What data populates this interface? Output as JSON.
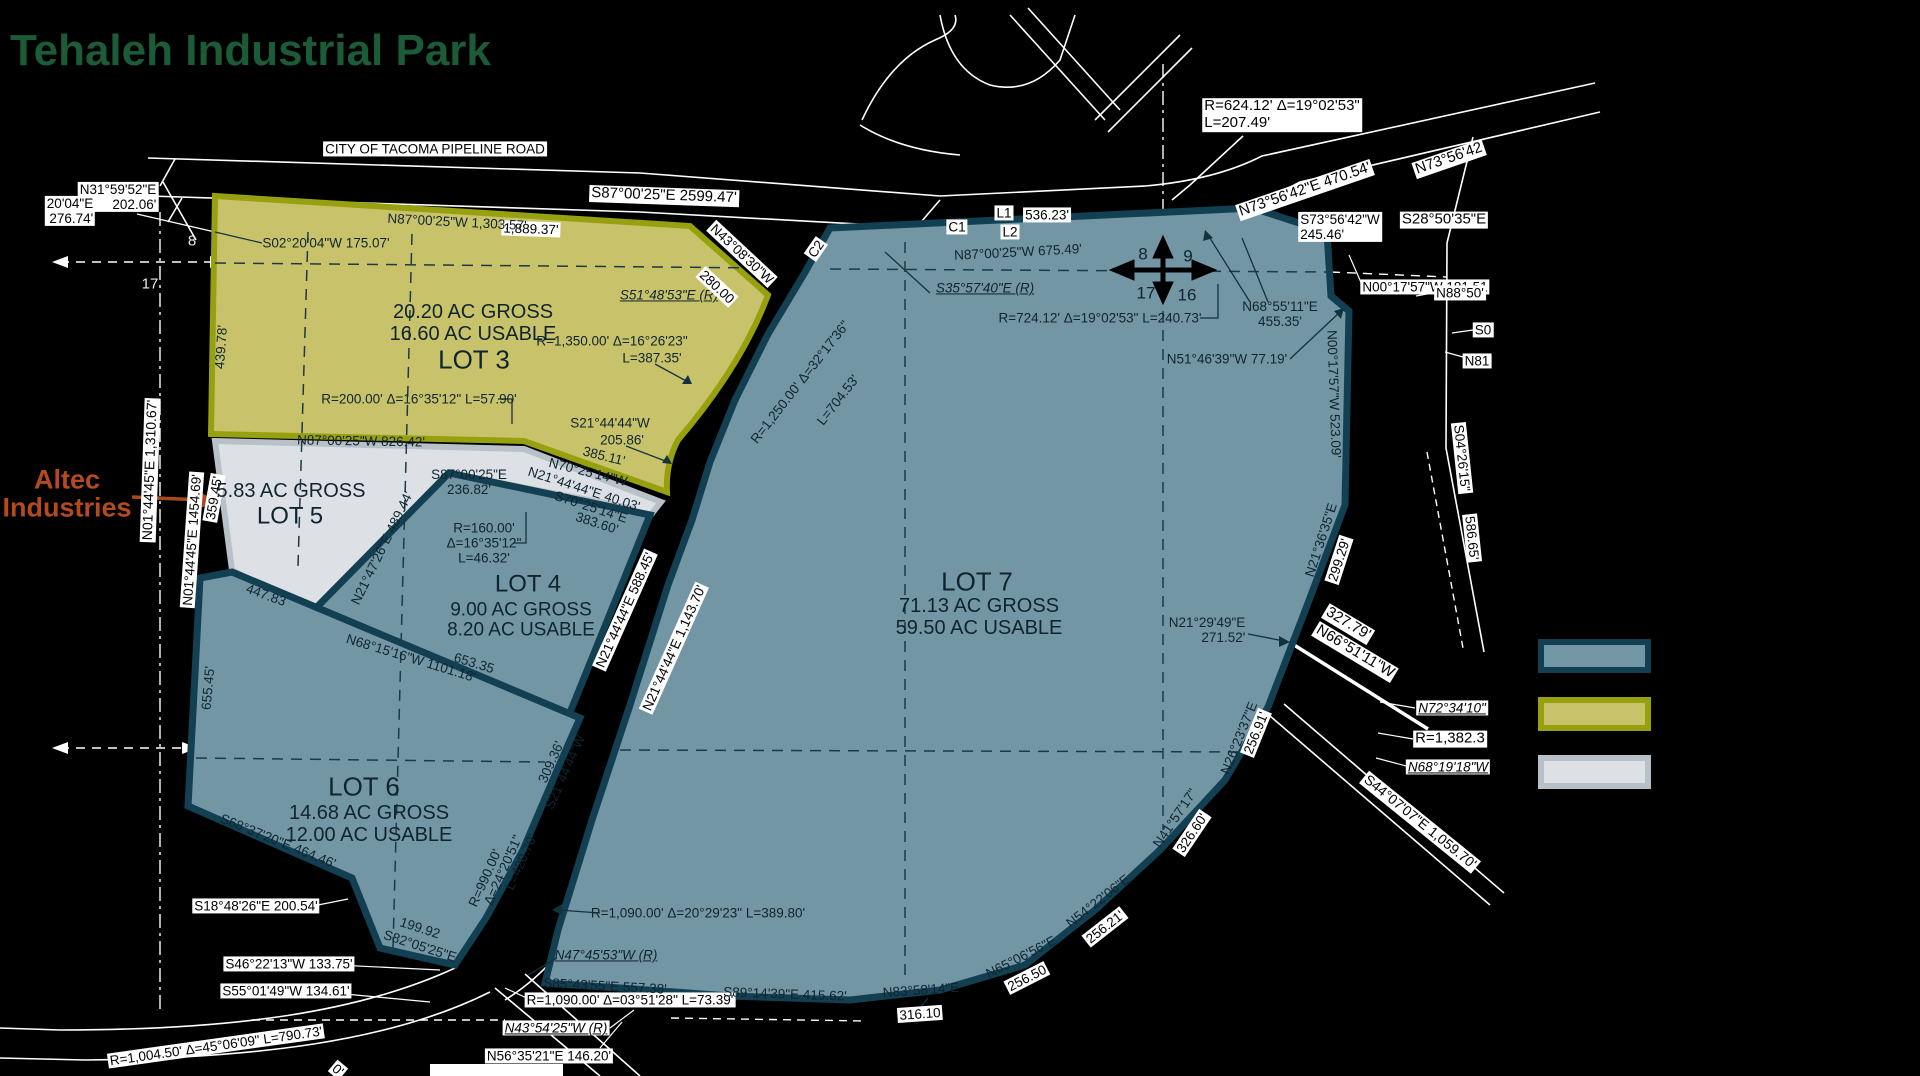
{
  "title": "Tehaleh Industrial Park",
  "legend": {
    "items": [
      {
        "name": "parcel-teal",
        "fill": "#7296a4",
        "border": "#123f52"
      },
      {
        "name": "parcel-olive",
        "fill": "#c8c36b",
        "border": "#97a00f"
      },
      {
        "name": "parcel-gray",
        "fill": "#dde1e6",
        "border": "#b8c0c8"
      }
    ]
  },
  "lots": [
    {
      "name": "LOT 3",
      "gross": "20.20 AC GROSS",
      "usable": "16.60 AC USABLE",
      "color": "#c8c36b"
    },
    {
      "name": "LOT 4",
      "gross": "9.00 AC GROSS",
      "usable": "8.20 AC USABLE",
      "color": "#7296a4"
    },
    {
      "name": "LOT 5",
      "gross": "5.83 AC GROSS",
      "usable": "",
      "color": "#dde1e6",
      "occupant": "Altec Industries"
    },
    {
      "name": "LOT 6",
      "gross": "14.68 AC GROSS",
      "usable": "12.00 AC USABLE",
      "color": "#7296a4"
    },
    {
      "name": "LOT 7",
      "gross": "71.13 AC GROSS",
      "usable": "59.50 AC USABLE",
      "color": "#7296a4"
    }
  ],
  "labels": [
    {
      "t": "CITY OF TACOMA PIPELINE ROAD",
      "x": 435,
      "y": 149,
      "s": "chip",
      "n": "road-name"
    },
    {
      "t": "N31°59'52\"E\n202.06'",
      "x": 118,
      "y": 197,
      "s": "chip",
      "al": "right"
    },
    {
      "t": "20'04\"E\n276.74'",
      "x": 70,
      "y": 211,
      "s": "chip",
      "al": "right"
    },
    {
      "t": "S87°00'25\"E  2599.47'",
      "x": 664,
      "y": 196,
      "r": 2,
      "s": "chip",
      "fs": 15
    },
    {
      "t": "1,889.37'",
      "x": 531,
      "y": 229,
      "r": 2,
      "s": "chip"
    },
    {
      "t": "N87°00'25\"W 1,303.57'",
      "x": 457,
      "y": 222,
      "r": 3,
      "s": "plain"
    },
    {
      "t": "S02°20'04\"W 175.07'",
      "x": 326,
      "y": 243,
      "s": "plain"
    },
    {
      "t": "439.78'",
      "x": 221,
      "y": 347,
      "r": -86,
      "s": "plain"
    },
    {
      "t": "20.20 AC GROSS",
      "x": 473,
      "y": 312,
      "s": "plain",
      "fs": 20,
      "n": "lot3-gross"
    },
    {
      "t": "16.60 AC USABLE",
      "x": 473,
      "y": 334,
      "s": "plain",
      "fs": 20,
      "n": "lot3-usable"
    },
    {
      "t": "LOT 3",
      "x": 474,
      "y": 360,
      "s": "plain",
      "fs": 26,
      "n": "lot3-title"
    },
    {
      "t": "S51°48'53\"E (R)",
      "x": 669,
      "y": 295,
      "s": "plainI"
    },
    {
      "t": "N43°08'30\"W",
      "x": 742,
      "y": 254,
      "r": 43,
      "s": "chip"
    },
    {
      "t": "280.00",
      "x": 717,
      "y": 287,
      "r": 43,
      "s": "chip"
    },
    {
      "t": "R=1,350.00' Δ=16°26'23\"",
      "x": 612,
      "y": 341,
      "s": "plain"
    },
    {
      "t": "L=387.35'",
      "x": 652,
      "y": 358,
      "s": "plain"
    },
    {
      "t": "R=200.00' Δ=16°35'12\" L=57.90'",
      "x": 419,
      "y": 399,
      "s": "plain"
    },
    {
      "t": "N87°00'25\"W 826.42'",
      "x": 361,
      "y": 441,
      "r": 1,
      "s": "plain"
    },
    {
      "t": "S21°44'44\"W",
      "x": 610,
      "y": 423,
      "s": "plain"
    },
    {
      "t": "205.86'",
      "x": 622,
      "y": 440,
      "s": "plain"
    },
    {
      "t": "385.11'",
      "x": 604,
      "y": 456,
      "r": 14,
      "s": "plain"
    },
    {
      "t": "N70°25'14\"W",
      "x": 588,
      "y": 472,
      "r": 14,
      "s": "plain"
    },
    {
      "t": "N21°44'44\"E 40.03'",
      "x": 584,
      "y": 489,
      "r": 18,
      "s": "plain"
    },
    {
      "t": "S70°25'14\"E",
      "x": 591,
      "y": 507,
      "r": 18,
      "s": "plain"
    },
    {
      "t": "383.60'",
      "x": 597,
      "y": 523,
      "r": 18,
      "s": "plain"
    },
    {
      "t": "S87°00'25\"E\n236.82'",
      "x": 469,
      "y": 482,
      "s": "plain"
    },
    {
      "t": "R=160.00'\nΔ=16°35'12\"\nL=46.32'",
      "x": 484,
      "y": 543,
      "s": "plain"
    },
    {
      "t": "LOT 4",
      "x": 528,
      "y": 585,
      "s": "plain",
      "fs": 24,
      "n": "lot4-title"
    },
    {
      "t": "9.00 AC GROSS",
      "x": 521,
      "y": 610,
      "s": "plain",
      "fs": 19,
      "n": "lot4-gross"
    },
    {
      "t": "8.20 AC USABLE",
      "x": 521,
      "y": 630,
      "s": "plain",
      "fs": 19,
      "n": "lot4-usable"
    },
    {
      "t": "N21°47'26\"E  489.44'",
      "x": 382,
      "y": 548,
      "r": -64,
      "s": "plain"
    },
    {
      "t": "N21°44'44\"E  588.45'",
      "x": 625,
      "y": 610,
      "r": -66,
      "s": "chip"
    },
    {
      "t": "N21°44'44\"E  1,143.70'",
      "x": 674,
      "y": 648,
      "r": -66,
      "s": "chip"
    },
    {
      "t": "N01°44'45\"E  1,310.67'",
      "x": 150,
      "y": 470,
      "r": -88,
      "s": "chip",
      "fs": 14
    },
    {
      "t": "N01°44'45\"E  1454.69'",
      "x": 192,
      "y": 540,
      "r": -86,
      "s": "chip"
    },
    {
      "t": "359.45'",
      "x": 214,
      "y": 498,
      "r": -80,
      "s": "chip"
    },
    {
      "t": "5.83 AC GROSS",
      "x": 291,
      "y": 491,
      "s": "plain",
      "fs": 20,
      "n": "lot5-gross"
    },
    {
      "t": "LOT 5",
      "x": 290,
      "y": 517,
      "s": "plain",
      "fs": 24,
      "n": "lot5-title"
    },
    {
      "t": "447.83",
      "x": 266,
      "y": 595,
      "r": 20,
      "s": "plain"
    },
    {
      "t": "Altec\nIndustries",
      "x": 67,
      "y": 494,
      "s": "altec",
      "n": "altec-industries-callout"
    },
    {
      "t": "N68°15'16\"W 1101.18'",
      "x": 411,
      "y": 658,
      "r": 17,
      "s": "plain"
    },
    {
      "t": "653.35",
      "x": 474,
      "y": 663,
      "r": 17,
      "s": "plain"
    },
    {
      "t": "655.45'",
      "x": 208,
      "y": 688,
      "r": -85,
      "s": "plain"
    },
    {
      "t": "LOT 6",
      "x": 364,
      "y": 787,
      "s": "plain",
      "fs": 26,
      "n": "lot6-title"
    },
    {
      "t": "14.68 AC GROSS",
      "x": 369,
      "y": 813,
      "s": "plain",
      "fs": 20,
      "n": "lot6-gross"
    },
    {
      "t": "12.00 AC USABLE",
      "x": 369,
      "y": 835,
      "s": "plain",
      "fs": 20,
      "n": "lot6-usable"
    },
    {
      "t": "S68°37'20\"E 464.46'",
      "x": 278,
      "y": 841,
      "r": 22,
      "s": "plain"
    },
    {
      "t": "309.36'",
      "x": 551,
      "y": 762,
      "r": -66,
      "s": "plain"
    },
    {
      "t": "S21°44'44\"W",
      "x": 565,
      "y": 772,
      "r": -66,
      "s": "plain"
    },
    {
      "t": "R=990.00'",
      "x": 485,
      "y": 878,
      "r": -66,
      "s": "plain"
    },
    {
      "t": "Δ=24°20'51\"",
      "x": 503,
      "y": 870,
      "r": -66,
      "s": "plain"
    },
    {
      "t": "L=420.70'",
      "x": 521,
      "y": 862,
      "r": -66,
      "s": "plain"
    },
    {
      "t": "S18°48'26\"E 200.54'",
      "x": 256,
      "y": 906,
      "s": "chip"
    },
    {
      "t": "199.92",
      "x": 420,
      "y": 928,
      "r": 18,
      "s": "plain"
    },
    {
      "t": "S82°05'25\"E",
      "x": 420,
      "y": 946,
      "r": 18,
      "s": "plain"
    },
    {
      "t": "S46°22'13\"W 133.75'",
      "x": 289,
      "y": 964,
      "s": "chip"
    },
    {
      "t": "S55°01'49\"W 134.61'",
      "x": 286,
      "y": 991,
      "s": "chip"
    },
    {
      "t": "R=1,004.50' Δ=45°06'09\" L=790.73'",
      "x": 216,
      "y": 1046,
      "r": -8,
      "s": "chip"
    },
    {
      "t": "0'",
      "x": 338,
      "y": 1070,
      "r": 40,
      "s": "chip"
    },
    {
      "t": "N56°35'21\"E 146.20'",
      "x": 549,
      "y": 1056,
      "s": "chip"
    },
    {
      "t": "N43°54'25\"W (R)",
      "x": 556,
      "y": 1028,
      "s": "chipI"
    },
    {
      "t": "R=1,090.00' Δ=03°51'28\" L=73.39'",
      "x": 630,
      "y": 1000,
      "s": "chip"
    },
    {
      "t": "N47°45'53\"W (R)",
      "x": 606,
      "y": 955,
      "s": "plainI"
    },
    {
      "t": "S85°43'55\"E 557.38'",
      "x": 605,
      "y": 986,
      "r": 3,
      "s": "plain"
    },
    {
      "t": "R=1,090.00' Δ=20°29'23\" L=389.80'",
      "x": 698,
      "y": 913,
      "s": "plain"
    },
    {
      "t": "S89°14'39\"E 415.62'",
      "x": 785,
      "y": 994,
      "r": 2,
      "s": "plain"
    },
    {
      "t": "N83°58'14\"E",
      "x": 921,
      "y": 990,
      "r": -4,
      "s": "plain"
    },
    {
      "t": "316.10",
      "x": 920,
      "y": 1014,
      "r": -4,
      "s": "chip"
    },
    {
      "t": "N65°06'56\"E",
      "x": 1021,
      "y": 957,
      "r": -27,
      "s": "plain"
    },
    {
      "t": "256.50",
      "x": 1027,
      "y": 978,
      "r": -27,
      "s": "chip"
    },
    {
      "t": "N54°22'06\"E",
      "x": 1098,
      "y": 901,
      "r": -38,
      "s": "plain"
    },
    {
      "t": "256.21'",
      "x": 1105,
      "y": 927,
      "r": -38,
      "s": "chip"
    },
    {
      "t": "N41°57'17\"",
      "x": 1175,
      "y": 818,
      "r": -56,
      "s": "plain"
    },
    {
      "t": "326.60'",
      "x": 1192,
      "y": 833,
      "r": -56,
      "s": "chip"
    },
    {
      "t": "N26°23'37\"E",
      "x": 1239,
      "y": 738,
      "r": -68,
      "s": "plain"
    },
    {
      "t": "256.91'",
      "x": 1256,
      "y": 733,
      "r": -68,
      "s": "chip"
    },
    {
      "t": "N21°36'35\"E",
      "x": 1321,
      "y": 540,
      "r": -72,
      "s": "plain"
    },
    {
      "t": "299.29'",
      "x": 1339,
      "y": 560,
      "r": -72,
      "s": "chip"
    },
    {
      "t": "N21°29'49\"E\n271.52'",
      "x": 1207,
      "y": 630,
      "s": "plain",
      "al": "right"
    },
    {
      "t": "LOT 7",
      "x": 977,
      "y": 582,
      "s": "plain",
      "fs": 26,
      "n": "lot7-title"
    },
    {
      "t": "71.13 AC GROSS",
      "x": 979,
      "y": 606,
      "s": "plain",
      "fs": 20,
      "n": "lot7-gross"
    },
    {
      "t": "59.50 AC USABLE",
      "x": 979,
      "y": 628,
      "s": "plain",
      "fs": 20,
      "n": "lot7-usable"
    },
    {
      "t": "N87°00'25\"W 675.49'",
      "x": 1018,
      "y": 252,
      "r": -3,
      "s": "plain"
    },
    {
      "t": "8",
      "x": 1143,
      "y": 254,
      "s": "plain",
      "fs": 17
    },
    {
      "t": "9",
      "x": 1188,
      "y": 256,
      "s": "plain",
      "fs": 17
    },
    {
      "t": "17",
      "x": 1146,
      "y": 293,
      "s": "plain",
      "fs": 17
    },
    {
      "t": "16",
      "x": 1187,
      "y": 295,
      "s": "plain",
      "fs": 17
    },
    {
      "t": "S35°57'40\"E (R)",
      "x": 985,
      "y": 288,
      "s": "plainI"
    },
    {
      "t": "R=724.12' Δ=19°02'53\" L=240.73'",
      "x": 1100,
      "y": 318,
      "s": "plain"
    },
    {
      "t": "N68°55'11\"E\n455.35'",
      "x": 1280,
      "y": 314,
      "s": "plain"
    },
    {
      "t": "N51°46'39\"W 77.19'",
      "x": 1227,
      "y": 359,
      "s": "plain"
    },
    {
      "t": "N00°17'57\"W  523.09'",
      "x": 1334,
      "y": 394,
      "r": 88,
      "s": "plain"
    },
    {
      "t": "N00°17'57\"W 181.51",
      "x": 1425,
      "y": 287,
      "s": "chip"
    },
    {
      "t": "S28°50'35\"E",
      "x": 1444,
      "y": 220,
      "s": "chip",
      "fs": 15
    },
    {
      "t": "S73°56'42\"W\n245.46'",
      "x": 1340,
      "y": 227,
      "s": "chip",
      "al": "left"
    },
    {
      "t": "N73°56'42\"E  470.54'",
      "x": 1305,
      "y": 190,
      "r": -19,
      "s": "chip",
      "fs": 15
    },
    {
      "t": "N73°56'42",
      "x": 1449,
      "y": 159,
      "r": -19,
      "s": "chip",
      "fs": 15
    },
    {
      "t": "R=624.12'  Δ=19°02'53\"\nL=207.49'",
      "x": 1282,
      "y": 115,
      "s": "chip",
      "al": "left",
      "fs": 15
    },
    {
      "t": "L1",
      "x": 1004,
      "y": 213,
      "s": "chip"
    },
    {
      "t": "536.23'",
      "x": 1047,
      "y": 215,
      "s": "chip"
    },
    {
      "t": "C1",
      "x": 957,
      "y": 227,
      "s": "chip"
    },
    {
      "t": "L2",
      "x": 1010,
      "y": 232,
      "s": "chip"
    },
    {
      "t": "C2",
      "x": 816,
      "y": 249,
      "r": -55,
      "s": "chip"
    },
    {
      "t": "R=1,250.00'  Δ=32°17'36\"",
      "x": 800,
      "y": 382,
      "r": -52,
      "s": "plain"
    },
    {
      "t": "L=704.53'",
      "x": 838,
      "y": 400,
      "r": -52,
      "s": "plain"
    },
    {
      "t": "327.79'",
      "x": 1348,
      "y": 624,
      "r": 31,
      "s": "chip",
      "fs": 15
    },
    {
      "t": "N66°51'11\"W",
      "x": 1355,
      "y": 652,
      "r": 31,
      "s": "chip",
      "fs": 15
    },
    {
      "t": "N72°34'10\"",
      "x": 1452,
      "y": 708,
      "s": "chipI"
    },
    {
      "t": "R=1,382.3",
      "x": 1450,
      "y": 739,
      "s": "chip",
      "fs": 15
    },
    {
      "t": "N68°19'18\"W",
      "x": 1448,
      "y": 767,
      "s": "chipI"
    },
    {
      "t": "S44°07'07\"E 1,059.70'",
      "x": 1420,
      "y": 822,
      "r": 39,
      "s": "chip",
      "fs": 14
    },
    {
      "t": "S04°26'15\"",
      "x": 1462,
      "y": 458,
      "r": 84,
      "s": "chip"
    },
    {
      "t": "586.65'",
      "x": 1472,
      "y": 538,
      "r": 84,
      "s": "chip"
    },
    {
      "t": "N88°50'",
      "x": 1460,
      "y": 293,
      "s": "chip"
    },
    {
      "t": "S0",
      "x": 1483,
      "y": 330,
      "s": "chip"
    },
    {
      "t": "N81",
      "x": 1477,
      "y": 361,
      "s": "chip"
    },
    {
      "t": "8",
      "x": 192,
      "y": 242,
      "s": "wlab"
    },
    {
      "t": "17",
      "x": 150,
      "y": 285,
      "s": "wlab"
    }
  ]
}
